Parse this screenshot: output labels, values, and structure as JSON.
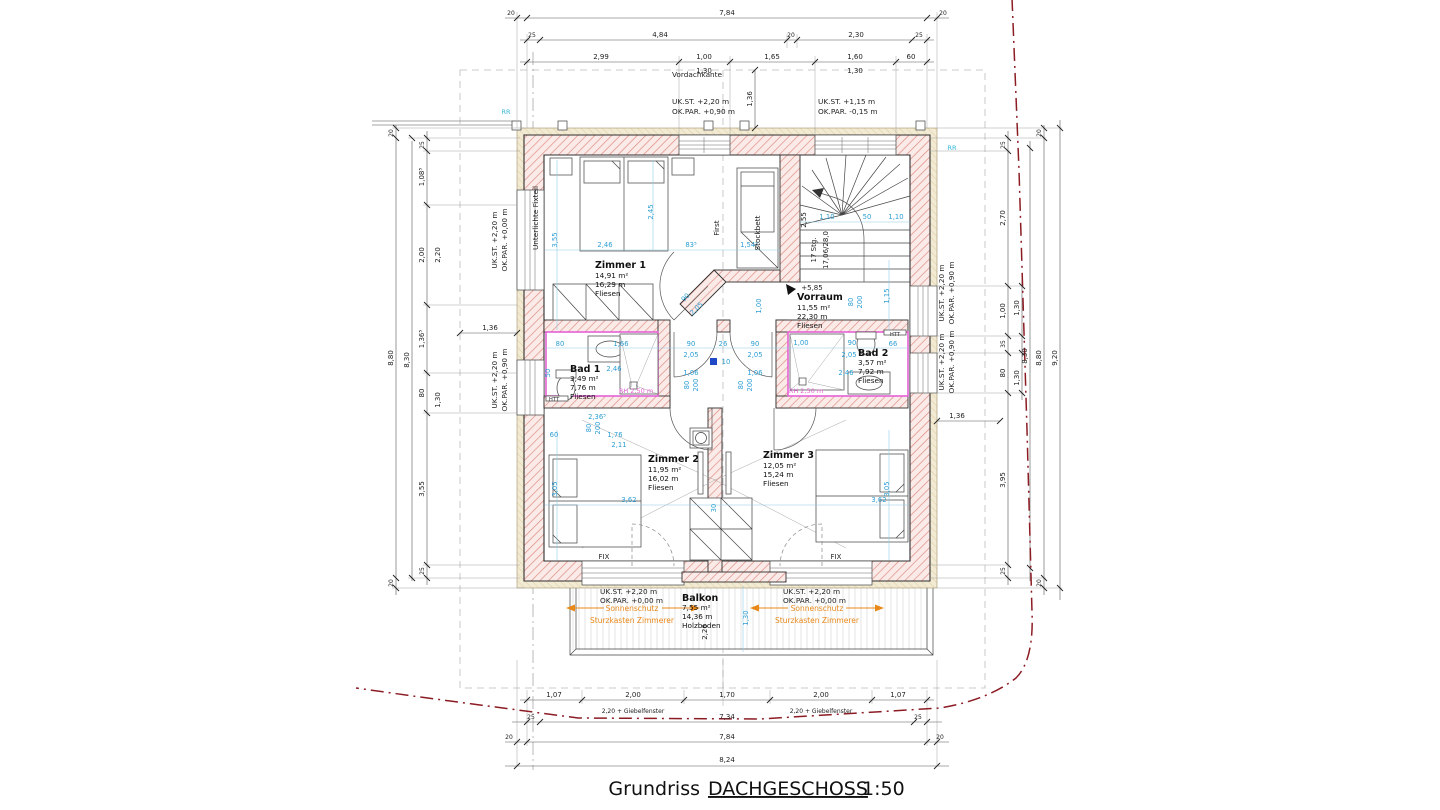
{
  "title": {
    "prefix": "Grundriss",
    "name": "DACHGESCHOSS",
    "scale": "1:50"
  },
  "colors": {
    "wall_hatch": "#dd8d84",
    "insulation": "#f0e8ce",
    "bath_outline": "#e561d6",
    "dim_blue": "#2e9fd4",
    "annotation_orange": "#e8891a",
    "boundary_red": "#8c1c24",
    "marker_cyan": "#36b5d8"
  },
  "rooms": {
    "zimmer1": {
      "name": "Zimmer 1",
      "area": "14,91 m²",
      "umfang": "16,29 m",
      "floor": "Fliesen"
    },
    "zimmer2": {
      "name": "Zimmer 2",
      "area": "11,95 m²",
      "umfang": "16,02 m",
      "floor": "Fliesen"
    },
    "zimmer3": {
      "name": "Zimmer 3",
      "area": "12,05 m²",
      "umfang": "15,24 m",
      "floor": "Fliesen"
    },
    "bad1": {
      "name": "Bad 1",
      "area": "3,49 m²",
      "umfang": "7,76 m",
      "floor": "Fliesen"
    },
    "bad2": {
      "name": "Bad 2",
      "area": "3,57 m²",
      "umfang": "7,92 m",
      "floor": "Fliesen"
    },
    "vorraum": {
      "name": "Vorraum",
      "area": "11,55 m²",
      "umfang": "22,30 m",
      "floor": "Fliesen"
    },
    "balkon": {
      "name": "Balkon",
      "area": "7,55 m²",
      "umfang": "14,36 m",
      "floor": "Holzboden"
    }
  },
  "levels": {
    "uk1": [
      "UK.ST. +2,20 m",
      "OK.PAR. +0,90 m"
    ],
    "uk2": [
      "UK.ST. +1,15 m",
      "OK.PAR. -0,15 m"
    ],
    "uk3": [
      "UK.ST. +2,20 m",
      "OK.PAR. +0,00 m"
    ],
    "uk4": [
      "UK.ST. +2,20 m",
      "OK.PAR. +0,90 m"
    ]
  },
  "annotations": {
    "vordachkante": "Vordachkante",
    "first": "First",
    "stockbett": "Stockbett",
    "unterlichte": "Unterlichte Fixteil",
    "fix": "FIX",
    "htt": "HTT",
    "rh": "RH 2,50 m",
    "rr": "RR",
    "sonnenschutz": "Sonnenschutz",
    "sturzkasten": "Sturzkasten Zimmerer",
    "stair_count": "17 Stg.",
    "stair_step": "17,06/28,0",
    "stair_level": "+5,85"
  },
  "dims": {
    "top1": [
      "20",
      "7,84",
      "20"
    ],
    "top2": [
      "25",
      "4,84",
      "20",
      "2,30",
      "25"
    ],
    "top3": [
      "2,99",
      "1,00",
      "1,65",
      "1,60",
      "60"
    ],
    "top4": [
      "1,30",
      "1,30"
    ],
    "bottom1": [
      "1,07",
      "2,00",
      "1,70",
      "2,00",
      "1,07"
    ],
    "bottom2": [
      "2,20 + Giebelfenster",
      "2,20 + Giebelfenster"
    ],
    "bottom3": [
      "25",
      "7,34",
      "25"
    ],
    "bottom4": [
      "20",
      "7,84",
      "20"
    ],
    "bottom5": [
      "8,24"
    ],
    "left1": [
      "20",
      "8,80",
      "20"
    ],
    "left2": [
      "25",
      "1,08⁵",
      "2,00",
      "1,36⁵",
      "80",
      "3,55",
      "25"
    ],
    "left3": [
      "8,30",
      "2,20",
      "1,30"
    ],
    "right1": [
      "20",
      "8,80",
      "20"
    ],
    "right2": [
      "25",
      "2,70",
      "1,00",
      "35",
      "80",
      "3,95",
      "25"
    ],
    "right3": [
      "1,30",
      "8,30",
      "1,30"
    ],
    "right4": [
      "9,20"
    ],
    "offsets": [
      "1,36",
      "1,36",
      "1,36"
    ],
    "blue": [
      "3,55",
      "2,46",
      "2,45",
      "83⁵",
      "1,54⁵",
      "1,10",
      "50",
      "1,10",
      "1,15",
      "1,00",
      "80",
      "200",
      "90",
      "26",
      "90",
      "2,05",
      "2,05",
      "1,06",
      "1,06",
      "10",
      "80",
      "1,66",
      "2,46",
      "50",
      "1,00",
      "90",
      "66",
      "2,05",
      "2,46",
      "2,36⁵",
      "1,76",
      "2,11",
      "3,05",
      "3,62",
      "30",
      "3,62",
      "3,05",
      "1,30",
      "90",
      "2,05",
      "80",
      "200",
      "80",
      "200",
      "80",
      "200"
    ],
    "black": [
      "2,55",
      "17 Stg.",
      "17,06/28,0",
      "+5,85",
      "60",
      "2,26"
    ]
  }
}
